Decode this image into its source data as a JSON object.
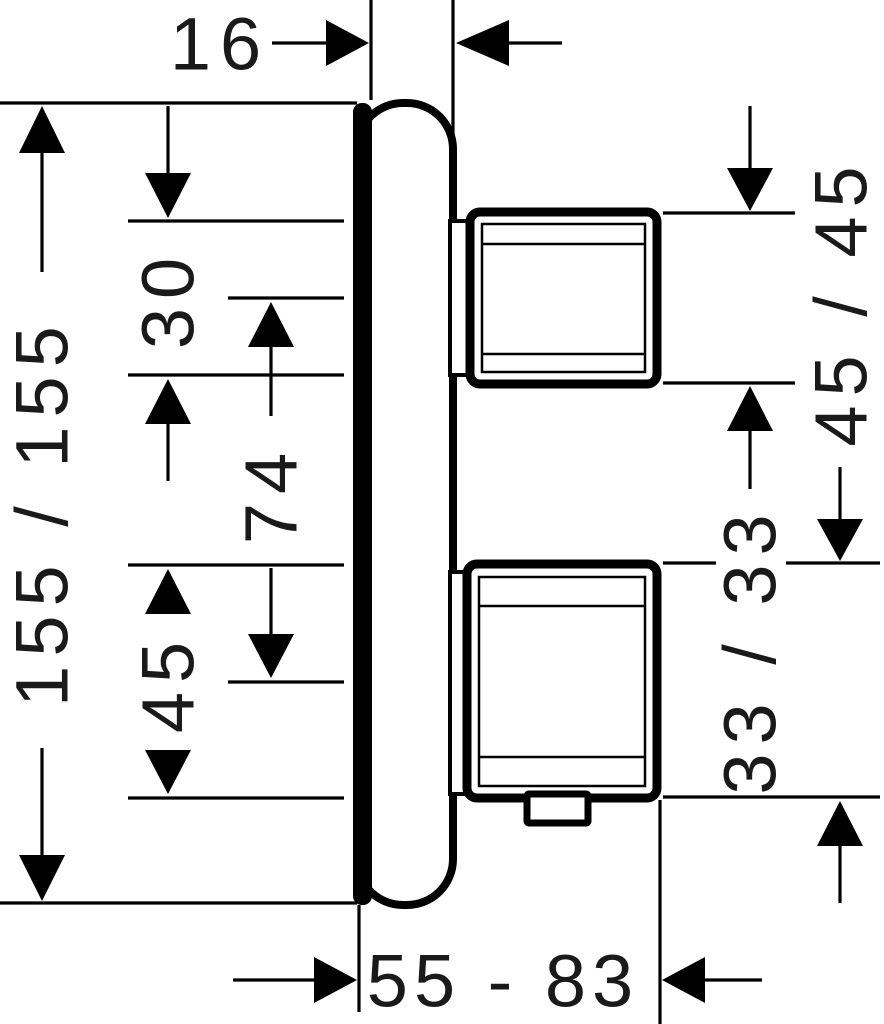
{
  "diagram": {
    "description": "Technical side-view dimension drawing of a concealed two-handle thermostat trim with wall escutcheon",
    "colors": {
      "ink": "#000000",
      "paper": "#ffffff"
    },
    "labels": {
      "plate_projection": "16",
      "plate_size": "155 / 155",
      "collar_height": "30",
      "handle_spacing": "74",
      "lower_handle_height": "45",
      "lower_handle_size": "45 / 45",
      "upper_handle_size": "33 / 33",
      "install_depth_range": "55 - 83"
    }
  }
}
